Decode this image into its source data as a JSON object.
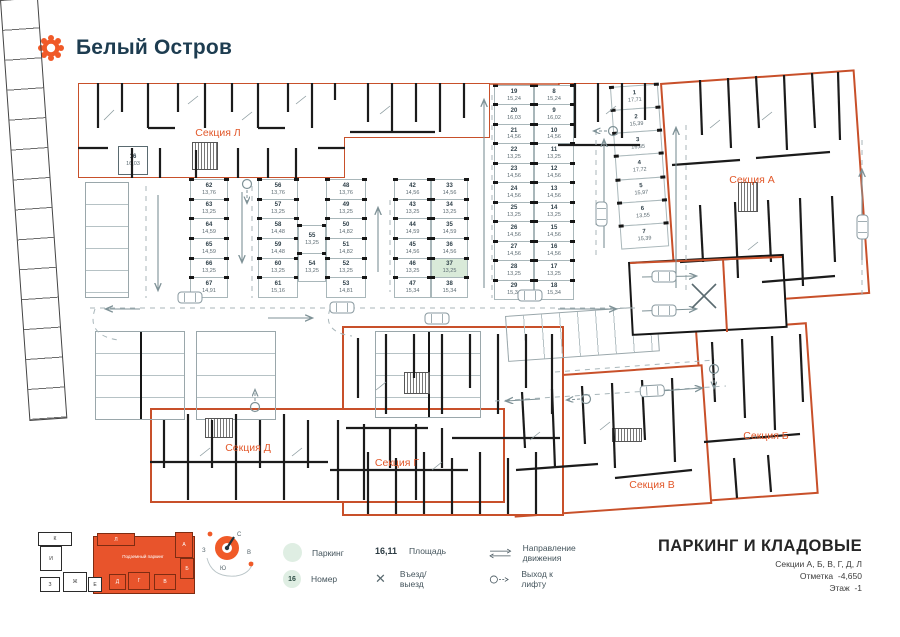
{
  "brand": {
    "name": "Белый Остров"
  },
  "plan": {
    "sections": [
      {
        "id": "L",
        "label": "Секция Л"
      },
      {
        "id": "A",
        "label": "Секция А"
      },
      {
        "id": "B",
        "label": "Секция Б"
      },
      {
        "id": "V",
        "label": "Секция В"
      },
      {
        "id": "G",
        "label": "Секция Г"
      },
      {
        "id": "D",
        "label": "Секция Д"
      }
    ],
    "storage_room": {
      "n": "16",
      "a": "16,03"
    },
    "parking_groups": {
      "g62": [
        {
          "n": "62",
          "a": "13,76"
        },
        {
          "n": "63",
          "a": "13,25"
        },
        {
          "n": "64",
          "a": "14,59"
        },
        {
          "n": "65",
          "a": "14,59"
        },
        {
          "n": "66",
          "a": "13,25"
        },
        {
          "n": "67",
          "a": "14,91"
        }
      ],
      "g56": [
        {
          "n": "56",
          "a": "13,76"
        },
        {
          "n": "57",
          "a": "13,25"
        },
        {
          "n": "58",
          "a": "14,48"
        },
        {
          "n": "59",
          "a": "14,48"
        },
        {
          "n": "60",
          "a": "13,25"
        },
        {
          "n": "61",
          "a": "15,16"
        }
      ],
      "g55": [
        {
          "n": "55",
          "a": "13,25"
        },
        {
          "n": "54",
          "a": "13,25"
        }
      ],
      "g48": [
        {
          "n": "48",
          "a": "13,76"
        },
        {
          "n": "49",
          "a": "13,25"
        },
        {
          "n": "50",
          "a": "14,82"
        },
        {
          "n": "51",
          "a": "14,82"
        },
        {
          "n": "52",
          "a": "13,25"
        },
        {
          "n": "53",
          "a": "14,81"
        }
      ],
      "g42": [
        {
          "n": "42",
          "a": "14,56"
        },
        {
          "n": "43",
          "a": "13,25"
        },
        {
          "n": "44",
          "a": "14,59"
        },
        {
          "n": "45",
          "a": "14,56"
        },
        {
          "n": "46",
          "a": "13,25"
        },
        {
          "n": "47",
          "a": "15,34"
        }
      ],
      "g33": [
        {
          "n": "33",
          "a": "14,56"
        },
        {
          "n": "34",
          "a": "13,25"
        },
        {
          "n": "35",
          "a": "14,59"
        },
        {
          "n": "36",
          "a": "14,56"
        },
        {
          "n": "37",
          "a": "13,25",
          "hl": true
        },
        {
          "n": "38",
          "a": "15,34"
        }
      ],
      "g19": [
        {
          "n": "19",
          "a": "15,24"
        },
        {
          "n": "20",
          "a": "16,03"
        },
        {
          "n": "21",
          "a": "14,56"
        },
        {
          "n": "22",
          "a": "13,25"
        },
        {
          "n": "23",
          "a": "14,56"
        },
        {
          "n": "24",
          "a": "14,56"
        },
        {
          "n": "25",
          "a": "13,25"
        },
        {
          "n": "26",
          "a": "14,56"
        },
        {
          "n": "27",
          "a": "14,56"
        },
        {
          "n": "28",
          "a": "13,25"
        },
        {
          "n": "29",
          "a": "15,34"
        }
      ],
      "g8": [
        {
          "n": "8",
          "a": "15,24"
        },
        {
          "n": "9",
          "a": "16,02"
        },
        {
          "n": "10",
          "a": "14,56"
        },
        {
          "n": "11",
          "a": "13,25"
        },
        {
          "n": "12",
          "a": "14,56"
        },
        {
          "n": "13",
          "a": "14,56"
        },
        {
          "n": "14",
          "a": "13,25"
        },
        {
          "n": "15",
          "a": "14,56"
        },
        {
          "n": "16",
          "a": "14,56"
        },
        {
          "n": "17",
          "a": "13,25"
        },
        {
          "n": "18",
          "a": "15,34"
        }
      ],
      "g1": [
        {
          "n": "1",
          "a": "17,71"
        },
        {
          "n": "2",
          "a": "15,39"
        },
        {
          "n": "3",
          "a": "16,85"
        },
        {
          "n": "4",
          "a": "17,72"
        },
        {
          "n": "5",
          "a": "15,97"
        },
        {
          "n": "6",
          "a": "13,55"
        },
        {
          "n": "7",
          "a": "15,39"
        }
      ]
    }
  },
  "minimap": {
    "caption": "Подземный паркинг",
    "white_blocks": [
      "К",
      "И",
      "З",
      "Ж",
      "Е"
    ],
    "orange_blocks": [
      "Л",
      "А",
      "Б",
      "Д",
      "Г",
      "В"
    ]
  },
  "compass": {
    "n": "С",
    "e": "В",
    "s": "Ю",
    "w": "З"
  },
  "legend": {
    "parking_label": "Паркинг",
    "number_example": "16",
    "number_label": "Номер",
    "area_example": "16,11",
    "area_label": "Площадь",
    "entry_label": "Въезд/выезд",
    "direction_label": "Направление движения",
    "lift_label": "Выход к лифту"
  },
  "title_block": {
    "title": "ПАРКИНГ И КЛАДОВЫЕ",
    "subtitle": "Секции А, Б, В, Г, Д, Л",
    "mark_label": "Отметка",
    "mark_value": "-4,650",
    "floor_label": "Этаж",
    "floor_value": "-1"
  },
  "colors": {
    "accent": "#E8542C",
    "section_border": "#C8502A",
    "stall_highlight": "#D9EAD9",
    "text_dark": "#1D3C50"
  }
}
